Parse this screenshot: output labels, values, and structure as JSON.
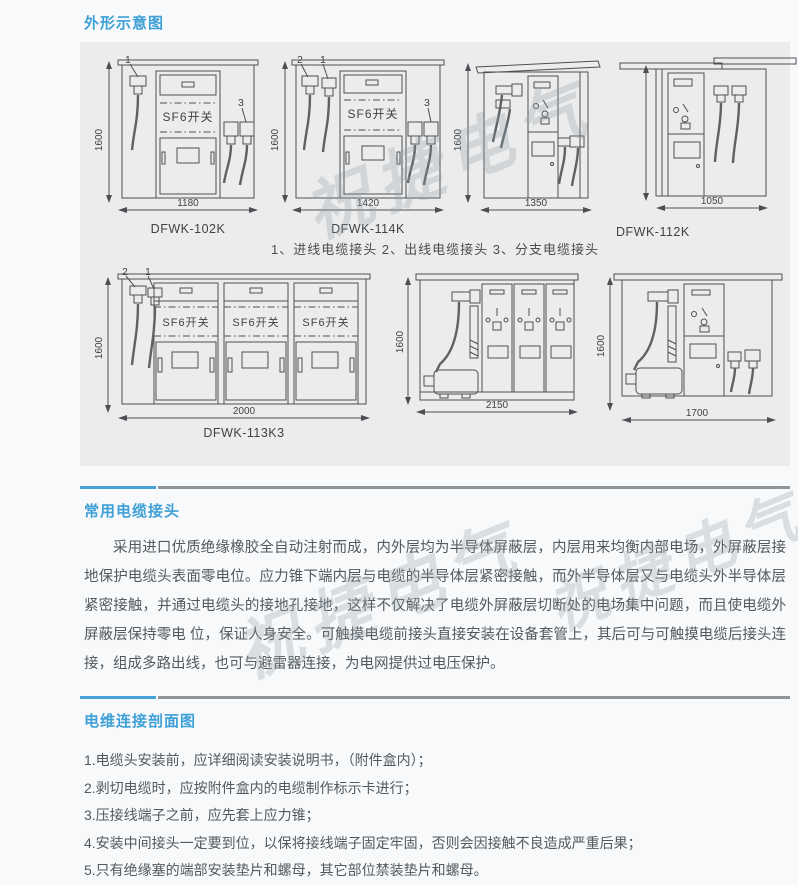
{
  "colors": {
    "accent": "#3ea0d6",
    "divider_gray": "#8f9497",
    "panel_bg": "#ececec",
    "body_text": "#55595c",
    "line": "#4c5054"
  },
  "watermark": {
    "text": "祝捷电气"
  },
  "outline_section": {
    "title": "外形示意图",
    "caption": "1、进线电缆接头  2、出线电缆接头  3、分支电缆接头",
    "sf6_label": "SF6开关",
    "cabinets": [
      {
        "model": "DFWK-102K",
        "width": "1180",
        "height": "1600",
        "callout1": "1",
        "callout3": "3"
      },
      {
        "model": "DFWK-114K",
        "width": "1420",
        "height": "1600",
        "callout1": "1",
        "callout2": "2",
        "callout3": "3"
      },
      {
        "model": "",
        "width": "1350",
        "height": "1600"
      },
      {
        "model": "DFWK-112K",
        "width": "1050",
        "height": ""
      },
      {
        "model": "DFWK-113K3",
        "width": "2000",
        "height": "1600",
        "callout1": "1",
        "callout2": "2"
      },
      {
        "model": "",
        "width": "2150",
        "height": "1600"
      },
      {
        "model": "",
        "width": "1700",
        "height": "1600"
      }
    ]
  },
  "cable_section": {
    "title": "常用电缆接头",
    "paragraph": "采用进口优质绝缘橡胶全自动注射而成，内外层均为半导体屏蔽层，内层用来均衡内部电场，外屏蔽层接地保护电缆头表面零电位。应力锥下端内层与电缆的半导体层紧密接触，而外半导体层又与电缆头外半导体层紧密接触，并通过电缆头的接地孔接地，这样不仅解决了电缆外屏蔽层切断处的电场集中问题，而且使电缆外屏蔽层保持零电 位，保证人身安全。可触摸电缆前接头直接安装在设备套管上，其后可与可触摸电缆后接头连接，组成多路出线，也可与避雷器连接，为电网提供过电压保护。"
  },
  "install_section": {
    "title": "电维连接剖面图",
    "items": [
      "1.电缆头安装前，应详细阅读安装说明书，（附件盒内）；",
      "2.剥切电缆时，应按附件盒内的电缆制作标示卡进行；",
      "3.压接线端子之前，应先套上应力锥；",
      "4.安装中间接头一定要到位，以保将接线端子固定牢固，否则会因接触不良造成严重后果；",
      "5.只有绝缘塞的端部安装垫片和螺母，其它部位禁装垫片和螺母。"
    ]
  }
}
